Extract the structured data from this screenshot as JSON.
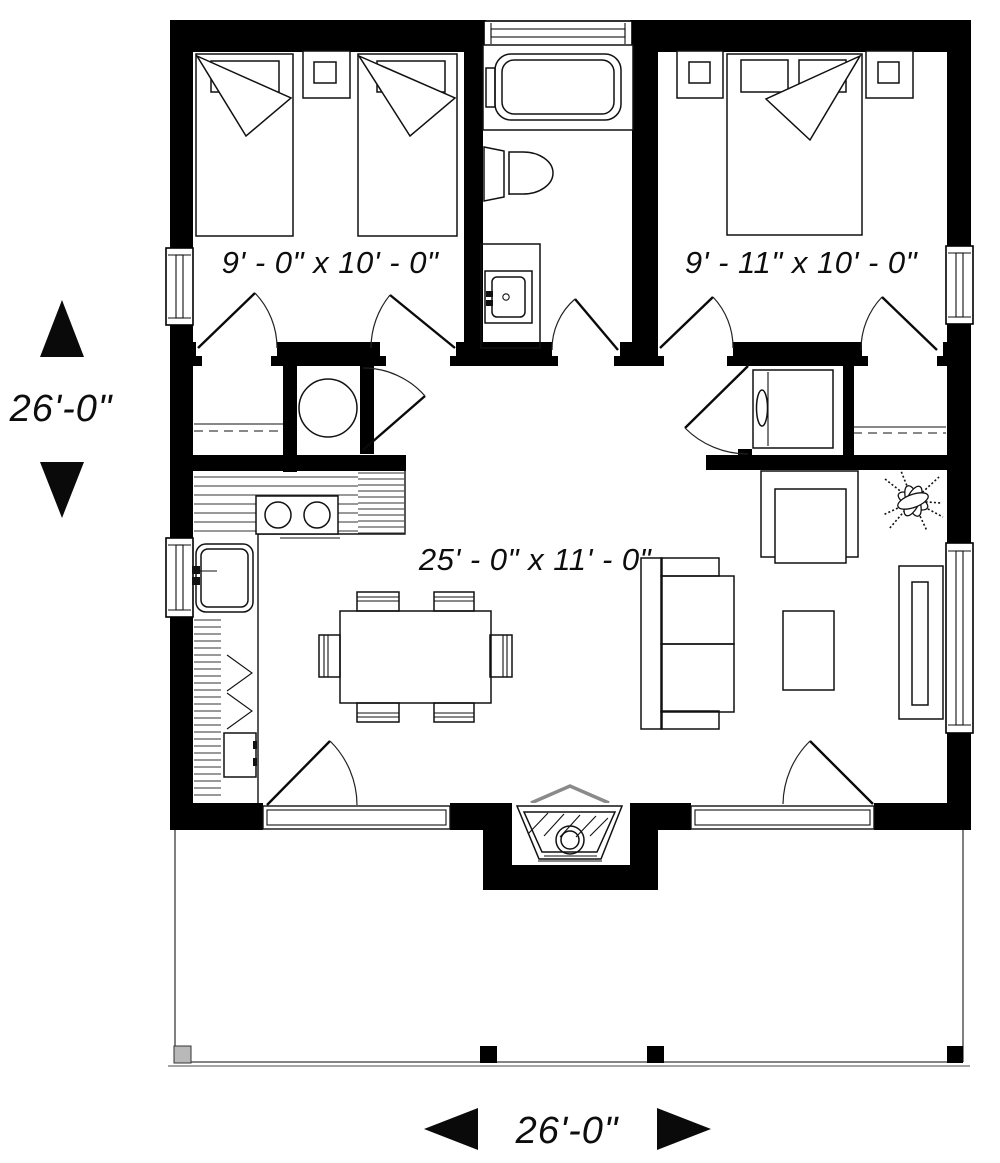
{
  "plan": {
    "title": "single-storey house floor plan",
    "rooms": [
      {
        "id": "bedroom_left",
        "label": "9' - 0\" x 10' - 0\""
      },
      {
        "id": "bedroom_right",
        "label": "9' - 11\" x 10' - 0\""
      },
      {
        "id": "living_kitchen",
        "label": "25' - 0\" x 11' - 0\""
      }
    ],
    "dimensions": {
      "left_overall": "26'-0\"",
      "bottom_overall": "26'-0\""
    },
    "colors": {
      "wall": "#000000",
      "line": "#111111",
      "roof_peak_gray": "#8a8a8a",
      "porch_post_gray": "#b9b9b9",
      "background": "#ffffff"
    },
    "fixtures": [
      "twin-bed",
      "twin-bed",
      "nightstand",
      "double-bed",
      "nightstand",
      "nightstand",
      "bathtub",
      "toilet",
      "vanity-sink",
      "water-heater-tank",
      "washer",
      "closet-rod",
      "closet-rod",
      "kitchen-counter",
      "range-cooktop",
      "kitchen-sink",
      "pantry-shelves",
      "base-cabinet",
      "dining-table",
      "dining-chair",
      "sofa",
      "armchair",
      "coffee-table",
      "tv-console",
      "potted-plant",
      "wood-stove-fireplace",
      "porch-deck",
      "porch-post"
    ]
  }
}
